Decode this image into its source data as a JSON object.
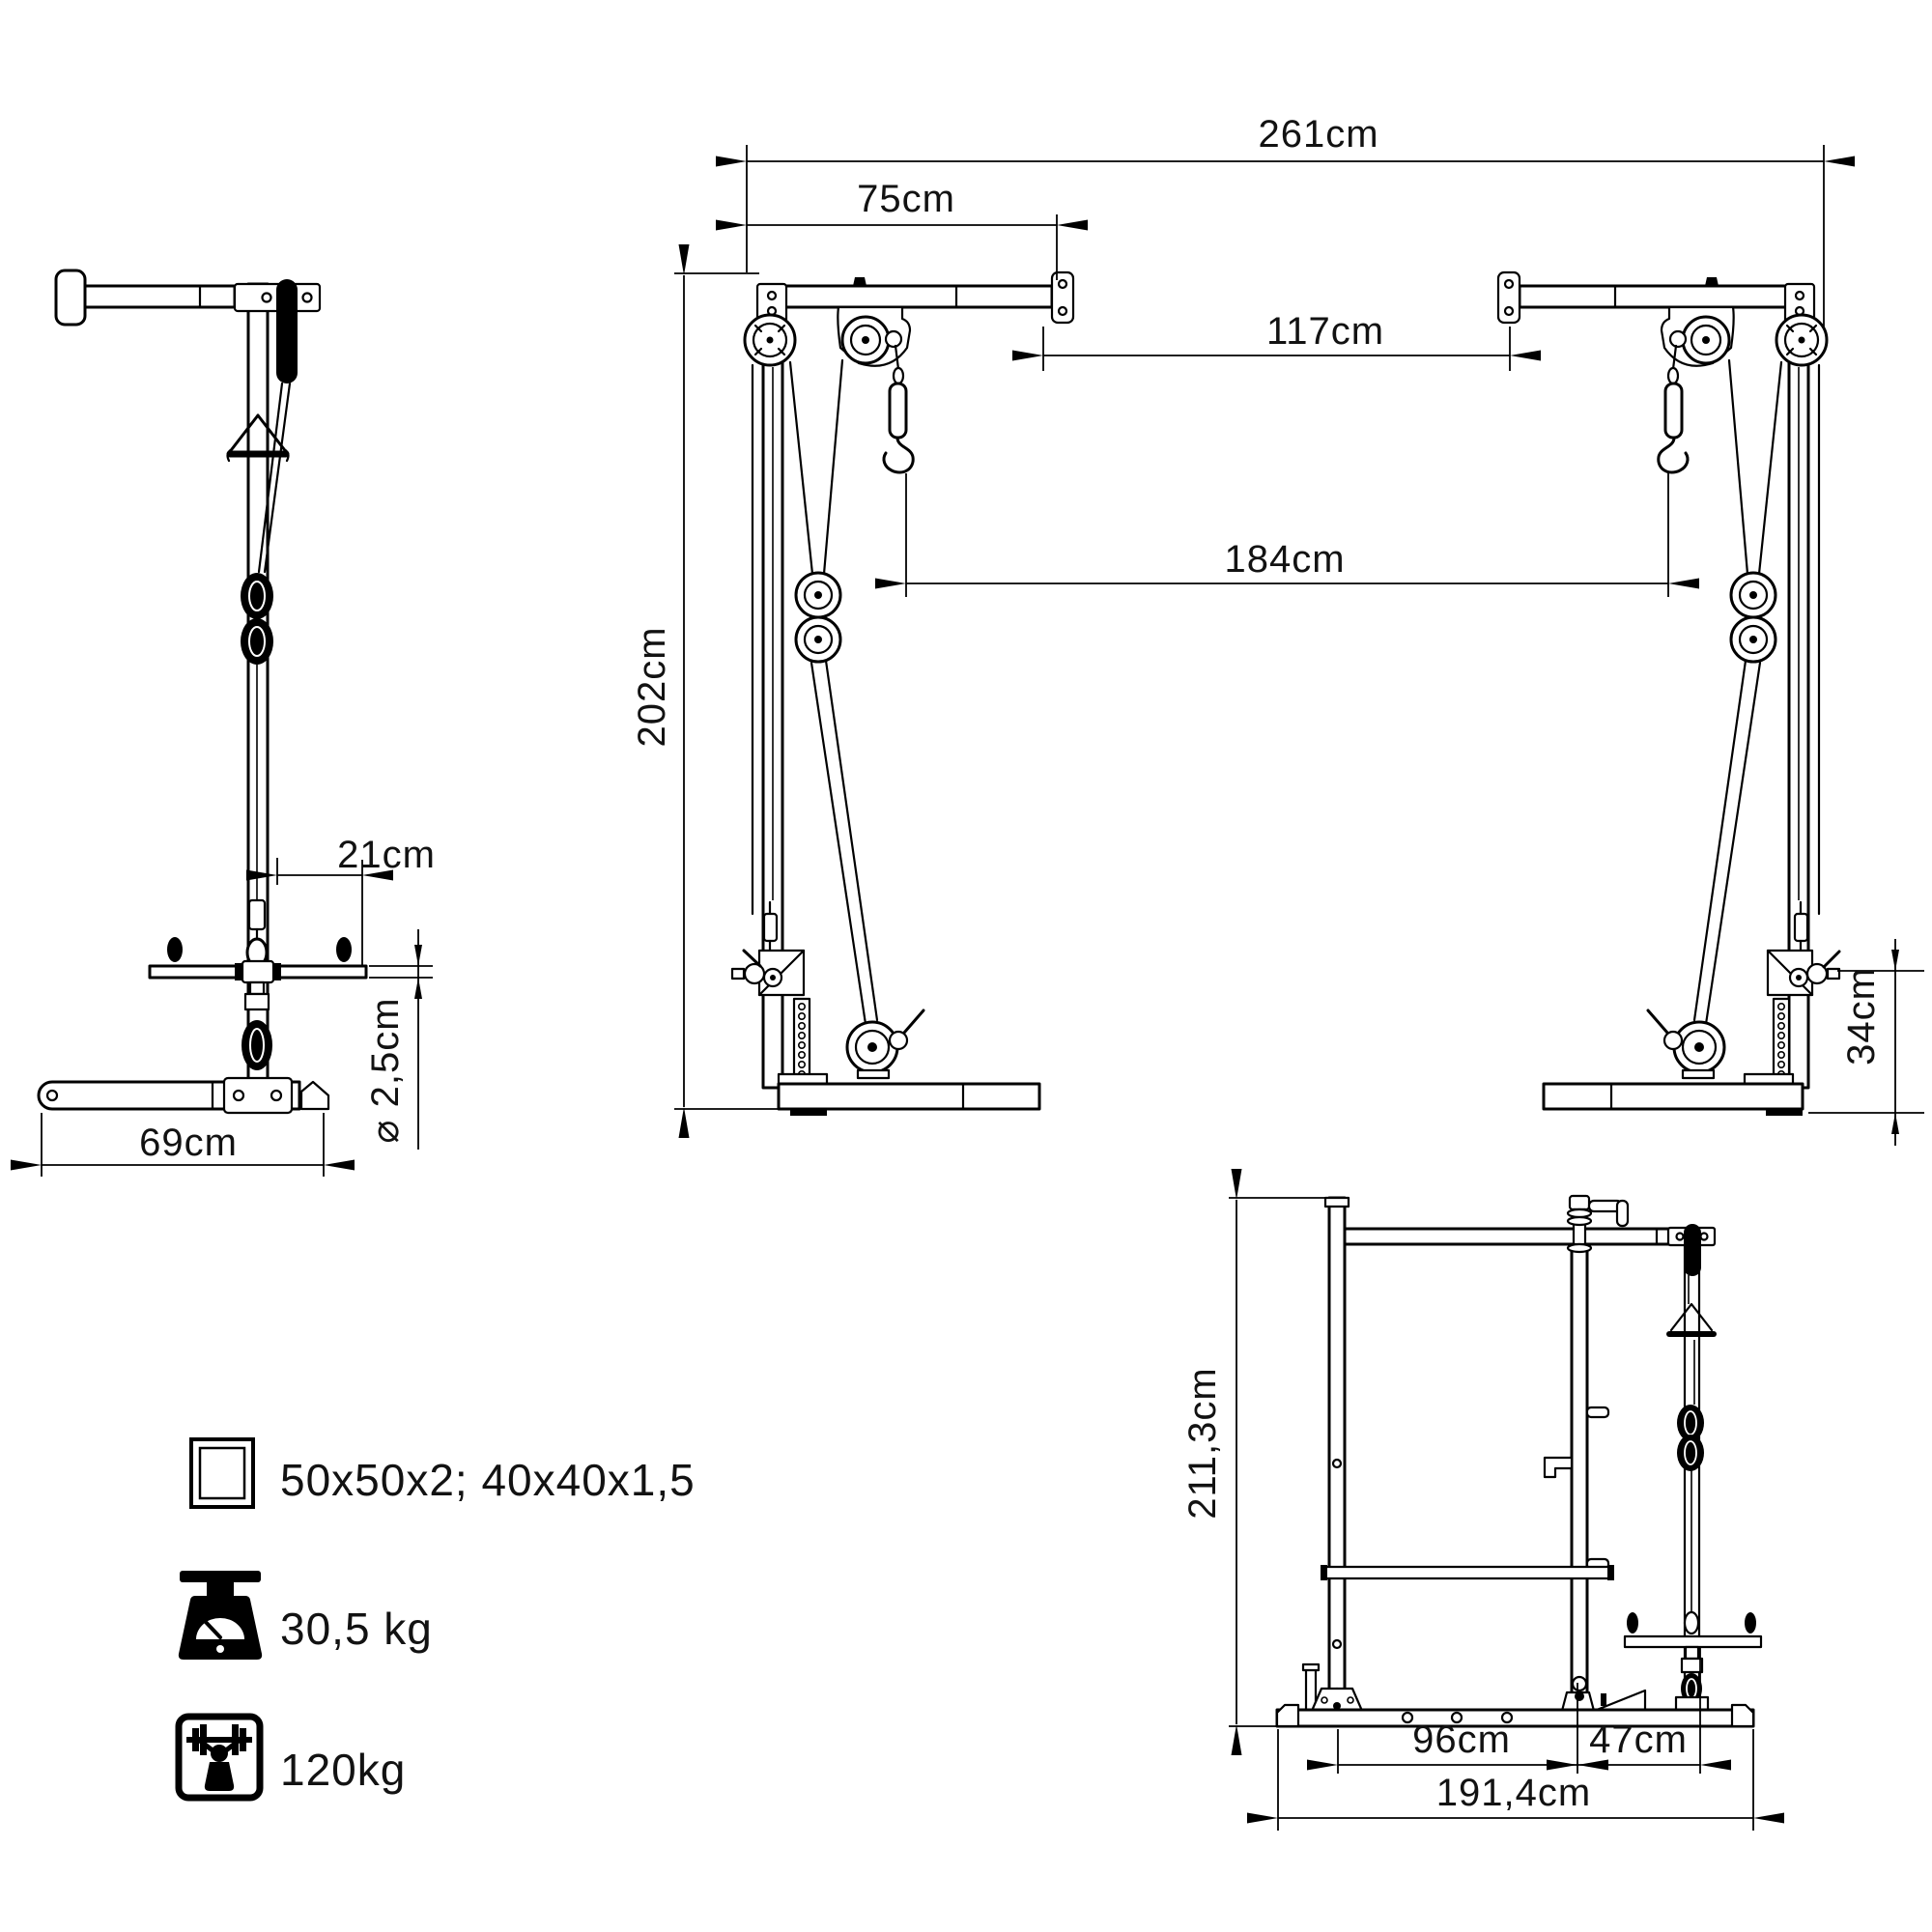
{
  "front_view": {
    "dims": {
      "overall_width": "261cm",
      "arm_length": "75cm",
      "inner_width": "117cm",
      "hook_spacing": "184cm",
      "height": "202cm",
      "low_pulley_height": "34cm"
    }
  },
  "side_view": {
    "dims": {
      "bar_offset": "21cm",
      "bar_diameter": "⌀ 2,5cm",
      "base_length": "69cm"
    }
  },
  "rack_view": {
    "dims": {
      "height": "211,3cm",
      "rack_depth": "96cm",
      "attachment_depth": "47cm",
      "overall_depth": "191,4cm"
    }
  },
  "specs": {
    "tube_profile": "50x50x2; 40x40x1,5",
    "weight": "30,5 kg",
    "max_load": "120kg"
  },
  "colors": {
    "line": "#000000",
    "background": "#ffffff"
  }
}
